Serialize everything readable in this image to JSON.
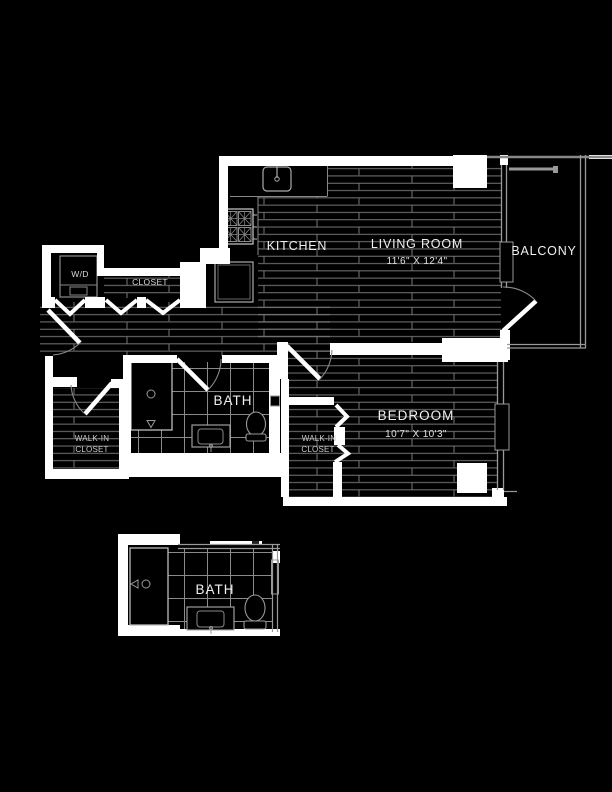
{
  "colors": {
    "background": "#000000",
    "wall": "#ffffff",
    "floor_line": "#787878",
    "tile_line": "#8a8a8a",
    "fixture_line": "#aaaaaa",
    "text": "#f0f0f0"
  },
  "rooms": {
    "kitchen": {
      "label": "KITCHEN"
    },
    "living_room": {
      "label": "LIVING ROOM",
      "dimensions": "11'6\" X 12'4\""
    },
    "balcony": {
      "label": "BALCONY"
    },
    "laundry": {
      "label": "W/D"
    },
    "hall_closet": {
      "label": "CLOSET"
    },
    "bathroom": {
      "label": "BATH"
    },
    "walk_in_closet": {
      "line1": "WALK-IN",
      "line2": "CLOSET"
    },
    "bedroom": {
      "label": "BEDROOM",
      "dimensions": "10'7\" X 10'3\""
    },
    "bedroom_closet": {
      "line1": "WALK-IN",
      "line2": "CLOSET"
    },
    "bathroom_detail": {
      "label": "BATH"
    }
  }
}
